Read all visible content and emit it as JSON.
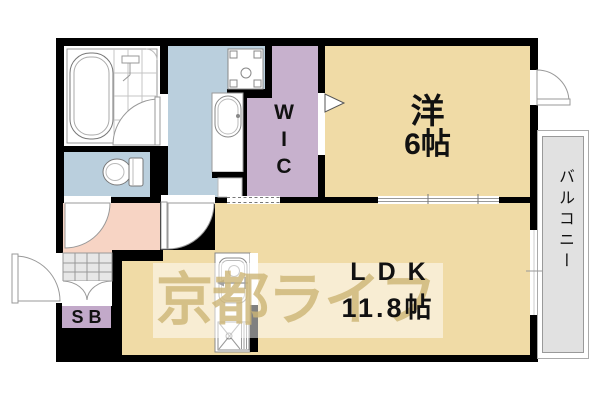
{
  "floorplan": {
    "watermark_text": "京都ライフ",
    "rooms": {
      "western": {
        "name": "洋",
        "size": "6帖"
      },
      "ldk": {
        "name": "LDK",
        "size": "11.8帖"
      },
      "wic": {
        "name": "WIC",
        "chars": [
          "W",
          "I",
          "C"
        ]
      },
      "balcony": {
        "name": "バルコニー"
      },
      "shoe_box": {
        "name": "SB"
      }
    },
    "fixture_icons": [
      "bathtub-icon",
      "toilet-icon",
      "washbasin-icon",
      "washing-machine-pan-icon",
      "kitchen-sink-icon",
      "gas-stove-icon",
      "door-swing-icon",
      "sliding-door-icon",
      "entrance-step-icon"
    ],
    "colors": {
      "floor": "#f0dba6",
      "wet": "#bacfdd",
      "wic": "#c7b1cd",
      "hall": "#f7d4c4",
      "sb": "#c2a9c9",
      "balcony": "#e1e1e1",
      "tile": "#e7e7e7",
      "wall": "#000000",
      "watermark": "#cdb575"
    }
  }
}
